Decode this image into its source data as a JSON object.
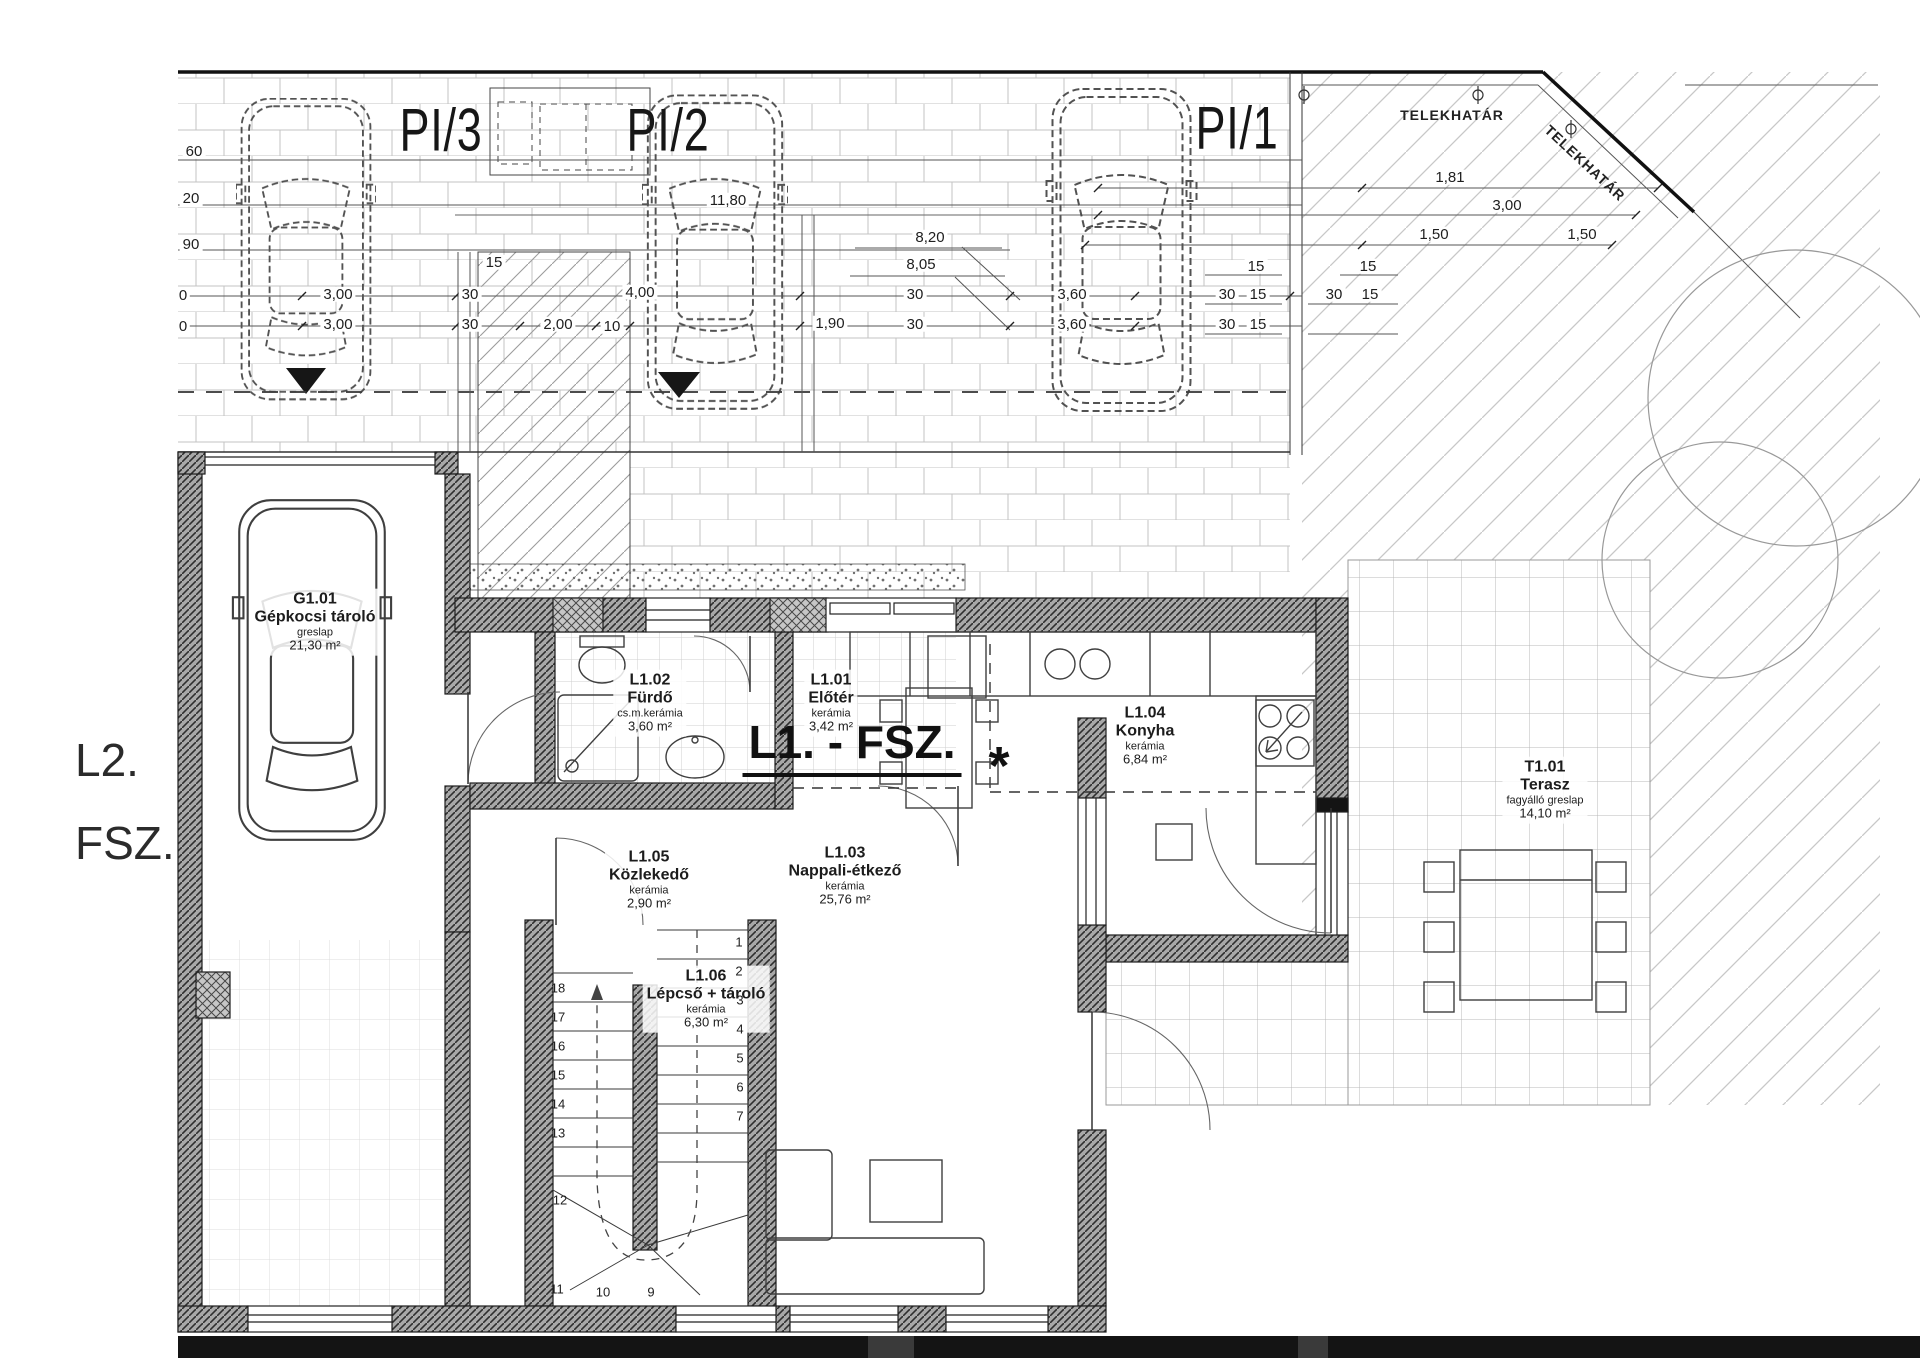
{
  "margin_labels": {
    "line1": "L2.",
    "line2": "FSZ."
  },
  "plan_title": "L1. - FSZ.",
  "boundary": {
    "horizontal_label": "TELEKHATÁR",
    "diagonal_label": "TELEKHATÁR"
  },
  "parking_spaces": [
    {
      "label": "PI/3"
    },
    {
      "label": "PI/2"
    },
    {
      "label": "PI/1"
    }
  ],
  "kitchen_marker": "*",
  "rooms": [
    {
      "code": "G1.01",
      "name": "Gépkocsi tároló",
      "material": "greslap",
      "area": "21,30 m²"
    },
    {
      "code": "L1.02",
      "name": "Fürdő",
      "material": "cs.m.kerámia",
      "area": "3,60 m²"
    },
    {
      "code": "L1.01",
      "name": "Előtér",
      "material": "kerámia",
      "area": "3,42 m²"
    },
    {
      "code": "L1.04",
      "name": "Konyha",
      "material": "kerámia",
      "area": "6,84 m²"
    },
    {
      "code": "L1.05",
      "name": "Közlekedő",
      "material": "kerámia",
      "area": "2,90 m²"
    },
    {
      "code": "L1.06",
      "name": "Lépcső + tároló",
      "material": "kerámia",
      "area": "6,30 m²"
    },
    {
      "code": "L1.03",
      "name": "Nappali-étkező",
      "material": "kerámia",
      "area": "25,76 m²"
    },
    {
      "code": "T1.01",
      "name": "Terasz",
      "material": "fagyálló greslap",
      "area": "14,10 m²"
    }
  ],
  "dimension_labels": [
    {
      "text": "60",
      "x": 194,
      "y": 152
    },
    {
      "text": "20",
      "x": 191,
      "y": 199
    },
    {
      "text": "90",
      "x": 191,
      "y": 245
    },
    {
      "text": "0",
      "x": 183,
      "y": 296
    },
    {
      "text": "0",
      "x": 183,
      "y": 327
    },
    {
      "text": "11,80",
      "x": 728,
      "y": 201
    },
    {
      "text": "8,20",
      "x": 930,
      "y": 238
    },
    {
      "text": "8,05",
      "x": 921,
      "y": 265
    },
    {
      "text": "3,00",
      "x": 338,
      "y": 295
    },
    {
      "text": "30",
      "x": 470,
      "y": 295
    },
    {
      "text": "4,00",
      "x": 640,
      "y": 293
    },
    {
      "text": "30",
      "x": 915,
      "y": 295
    },
    {
      "text": "3,60",
      "x": 1072,
      "y": 295
    },
    {
      "text": "30",
      "x": 1227,
      "y": 295
    },
    {
      "text": "15",
      "x": 1258,
      "y": 295
    },
    {
      "text": "30",
      "x": 1334,
      "y": 295
    },
    {
      "text": "15",
      "x": 1370,
      "y": 295
    },
    {
      "text": "3,00",
      "x": 338,
      "y": 325
    },
    {
      "text": "30",
      "x": 470,
      "y": 325
    },
    {
      "text": "2,00",
      "x": 558,
      "y": 325
    },
    {
      "text": "10",
      "x": 612,
      "y": 327
    },
    {
      "text": "1,90",
      "x": 830,
      "y": 324
    },
    {
      "text": "30",
      "x": 915,
      "y": 325
    },
    {
      "text": "3,60",
      "x": 1072,
      "y": 325
    },
    {
      "text": "30",
      "x": 1227,
      "y": 325
    },
    {
      "text": "15",
      "x": 1258,
      "y": 325
    },
    {
      "text": "15",
      "x": 1256,
      "y": 267
    },
    {
      "text": "15",
      "x": 1368,
      "y": 267
    },
    {
      "text": "1,81",
      "x": 1450,
      "y": 178
    },
    {
      "text": "3,00",
      "x": 1507,
      "y": 206
    },
    {
      "text": "1,50",
      "x": 1434,
      "y": 235
    },
    {
      "text": "1,50",
      "x": 1582,
      "y": 235
    },
    {
      "text": "15",
      "x": 494,
      "y": 263
    }
  ],
  "stair_step_numbers": [
    {
      "n": "18",
      "x": 558,
      "y": 988
    },
    {
      "n": "17",
      "x": 558,
      "y": 1017
    },
    {
      "n": "16",
      "x": 558,
      "y": 1046
    },
    {
      "n": "15",
      "x": 558,
      "y": 1075
    },
    {
      "n": "14",
      "x": 558,
      "y": 1104
    },
    {
      "n": "13",
      "x": 558,
      "y": 1133
    },
    {
      "n": "12",
      "x": 560,
      "y": 1200
    },
    {
      "n": "11",
      "x": 557,
      "y": 1289
    },
    {
      "n": "10",
      "x": 603,
      "y": 1292
    },
    {
      "n": "9",
      "x": 651,
      "y": 1292
    },
    {
      "n": "1",
      "x": 739,
      "y": 942
    },
    {
      "n": "2",
      "x": 739,
      "y": 971
    },
    {
      "n": "3",
      "x": 740,
      "y": 1000
    },
    {
      "n": "4",
      "x": 740,
      "y": 1029
    },
    {
      "n": "5",
      "x": 740,
      "y": 1058
    },
    {
      "n": "6",
      "x": 740,
      "y": 1087
    },
    {
      "n": "7",
      "x": 740,
      "y": 1116
    }
  ]
}
